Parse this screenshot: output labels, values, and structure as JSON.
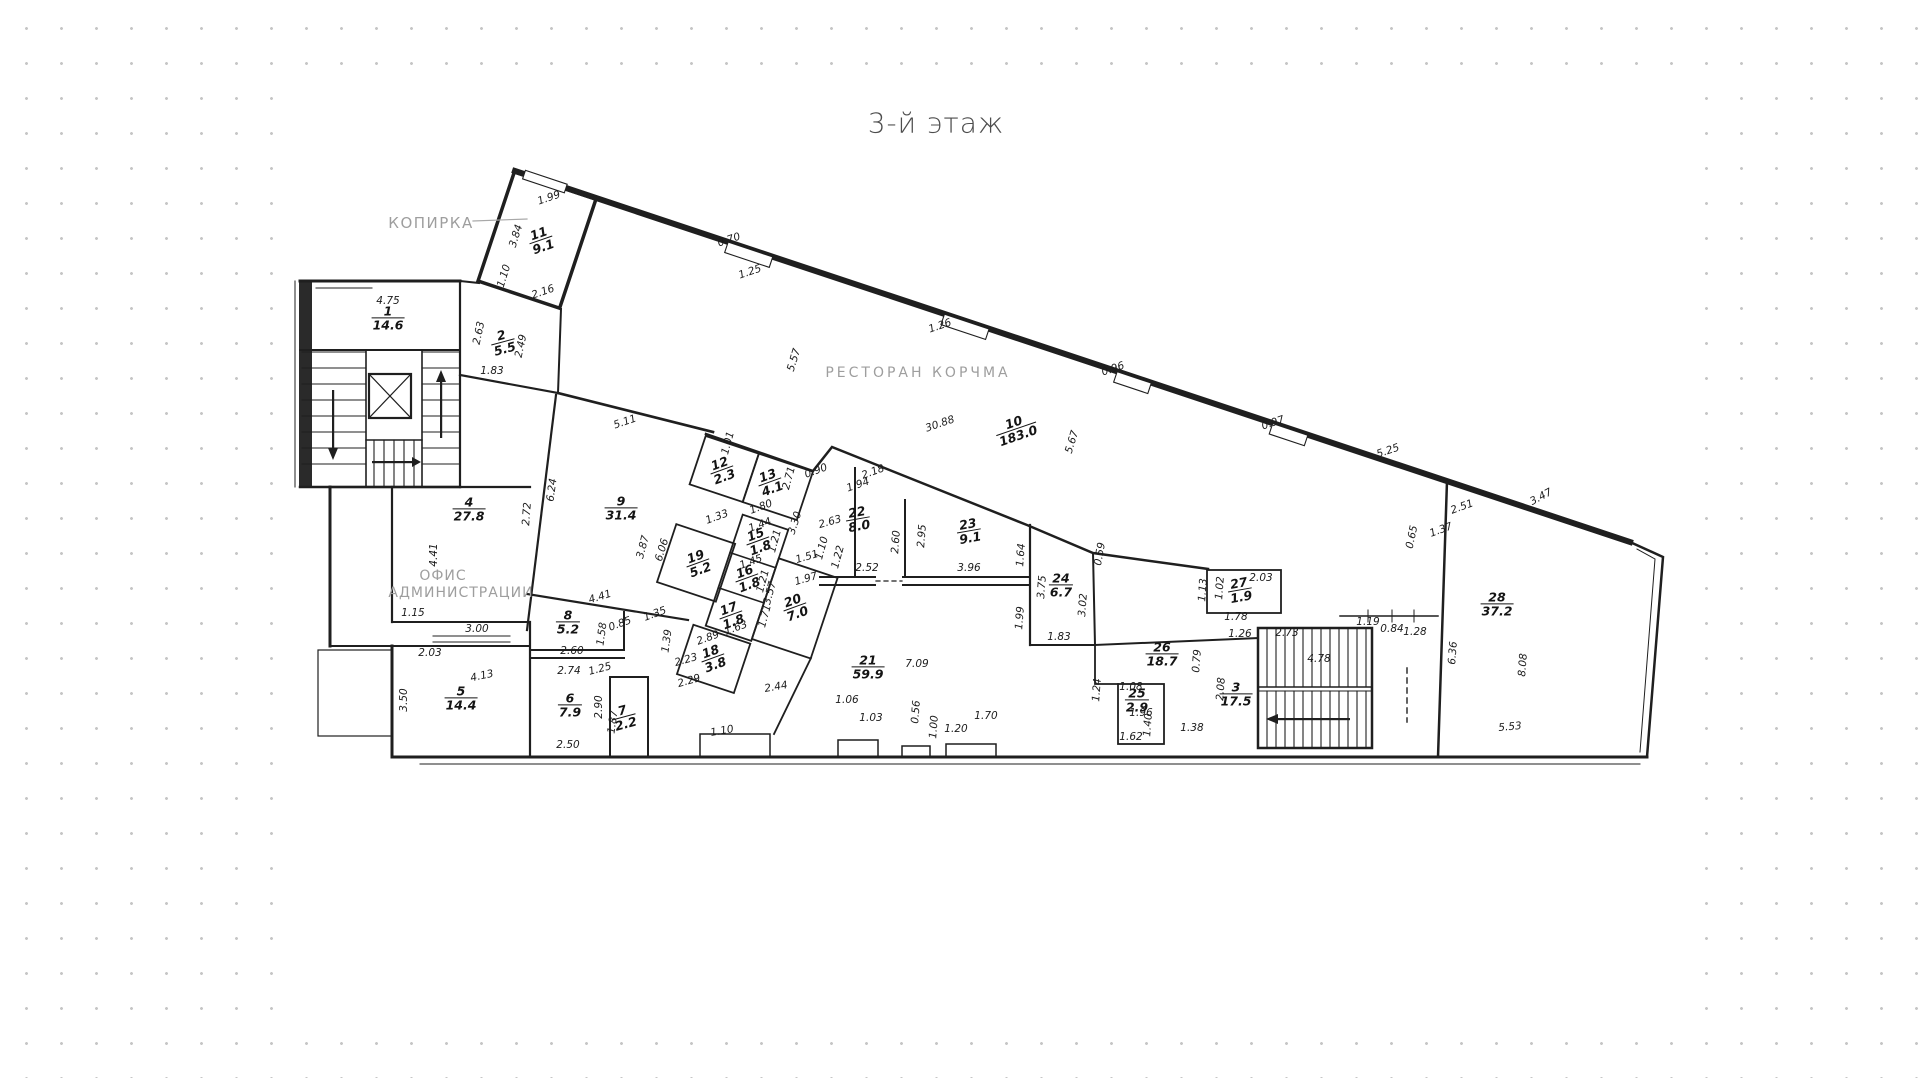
{
  "title": "3-й этаж",
  "labels": {
    "kopirka": "КОПИРКА",
    "restaurant": "РЕСТОРАН  КОРЧМА",
    "office_line1": "ОФИС",
    "office_line2": "АДМИНИСТРАЦИИ"
  },
  "colors": {
    "ink": "#1f1f1f",
    "muted_label": "#9e9e9e",
    "dots": "#c6c6c6",
    "paper": "#ffffff",
    "title_text": "#4d4d4d"
  },
  "rooms": [
    {
      "num": "1",
      "area": "14.6",
      "x": 388,
      "y": 318,
      "r": 0
    },
    {
      "num": "2",
      "area": "5.5",
      "x": 503,
      "y": 342,
      "r": -15
    },
    {
      "num": "3",
      "area": "17.5",
      "x": 1236,
      "y": 694,
      "r": 0
    },
    {
      "num": "4",
      "area": "27.8",
      "x": 469,
      "y": 509,
      "r": 0
    },
    {
      "num": "5",
      "area": "14.4",
      "x": 461,
      "y": 698,
      "r": 0
    },
    {
      "num": "6",
      "area": "7.9",
      "x": 570,
      "y": 705,
      "r": 0
    },
    {
      "num": "7",
      "area": "2.2",
      "x": 624,
      "y": 717,
      "r": -15
    },
    {
      "num": "8",
      "area": "5.2",
      "x": 568,
      "y": 622,
      "r": 0
    },
    {
      "num": "9",
      "area": "31.4",
      "x": 621,
      "y": 508,
      "r": 0
    },
    {
      "num": "10",
      "area": "183.0",
      "x": 1016,
      "y": 429,
      "r": -19
    },
    {
      "num": "11",
      "area": "9.1",
      "x": 541,
      "y": 240,
      "r": -19
    },
    {
      "num": "12",
      "area": "2.3",
      "x": 722,
      "y": 470,
      "r": -20
    },
    {
      "num": "13",
      "area": "4.1",
      "x": 770,
      "y": 482,
      "r": -20
    },
    {
      "num": "15",
      "area": "1.8",
      "x": 758,
      "y": 541,
      "r": -20
    },
    {
      "num": "16",
      "area": "1.8",
      "x": 747,
      "y": 578,
      "r": -20
    },
    {
      "num": "17",
      "area": "1.8",
      "x": 731,
      "y": 615,
      "r": -20
    },
    {
      "num": "18",
      "area": "3.8",
      "x": 713,
      "y": 658,
      "r": -20
    },
    {
      "num": "19",
      "area": "5.2",
      "x": 698,
      "y": 563,
      "r": -20
    },
    {
      "num": "20",
      "area": "7.0",
      "x": 795,
      "y": 607,
      "r": -20
    },
    {
      "num": "21",
      "area": "59.9",
      "x": 868,
      "y": 667,
      "r": 0
    },
    {
      "num": "22",
      "area": "8.0",
      "x": 858,
      "y": 519,
      "r": -10
    },
    {
      "num": "23",
      "area": "9.1",
      "x": 969,
      "y": 531,
      "r": -10
    },
    {
      "num": "24",
      "area": "6.7",
      "x": 1061,
      "y": 585,
      "r": 0
    },
    {
      "num": "25",
      "area": "2.9",
      "x": 1137,
      "y": 700,
      "r": 0
    },
    {
      "num": "26",
      "area": "18.7",
      "x": 1162,
      "y": 654,
      "r": 0
    },
    {
      "num": "27",
      "area": "1.9",
      "x": 1240,
      "y": 590,
      "r": -10
    },
    {
      "num": "28",
      "area": "37.2",
      "x": 1497,
      "y": 604,
      "r": 0
    }
  ],
  "dims": [
    {
      "t": "4.75",
      "x": 388,
      "y": 301,
      "r": 0
    },
    {
      "t": "2.63",
      "x": 479,
      "y": 333,
      "r": -78
    },
    {
      "t": "2.49",
      "x": 521,
      "y": 346,
      "r": -78
    },
    {
      "t": "1.83",
      "x": 492,
      "y": 371,
      "r": 0
    },
    {
      "t": "1.99",
      "x": 549,
      "y": 198,
      "r": -19
    },
    {
      "t": "3.84",
      "x": 516,
      "y": 236,
      "r": -73
    },
    {
      "t": "1.10",
      "x": 504,
      "y": 276,
      "r": -73
    },
    {
      "t": "2.16",
      "x": 543,
      "y": 292,
      "r": -19
    },
    {
      "t": "0.70",
      "x": 729,
      "y": 240,
      "r": -19
    },
    {
      "t": "1.25",
      "x": 750,
      "y": 272,
      "r": -19
    },
    {
      "t": "5.57",
      "x": 794,
      "y": 360,
      "r": -73
    },
    {
      "t": "1.26",
      "x": 940,
      "y": 326,
      "r": -19
    },
    {
      "t": "0.96",
      "x": 1113,
      "y": 369,
      "r": -19
    },
    {
      "t": "0.97",
      "x": 1273,
      "y": 423,
      "r": -19
    },
    {
      "t": "5.25",
      "x": 1388,
      "y": 451,
      "r": -19
    },
    {
      "t": "30.88",
      "x": 940,
      "y": 424,
      "r": -19
    },
    {
      "t": "5.67",
      "x": 1072,
      "y": 442,
      "r": -73
    },
    {
      "t": "5.11",
      "x": 625,
      "y": 422,
      "r": -19
    },
    {
      "t": "6.24",
      "x": 552,
      "y": 490,
      "r": -82
    },
    {
      "t": "6.06",
      "x": 662,
      "y": 550,
      "r": -73
    },
    {
      "t": "4.41",
      "x": 600,
      "y": 597,
      "r": -17
    },
    {
      "t": "4.41",
      "x": 434,
      "y": 555,
      "r": -90
    },
    {
      "t": "2.72",
      "x": 527,
      "y": 514,
      "r": -86
    },
    {
      "t": "1.15",
      "x": 413,
      "y": 613,
      "r": 0
    },
    {
      "t": "3.00",
      "x": 477,
      "y": 629,
      "r": 0
    },
    {
      "t": "2.03",
      "x": 430,
      "y": 653,
      "r": 0
    },
    {
      "t": "3.50",
      "x": 404,
      "y": 700,
      "r": -90
    },
    {
      "t": "4.13",
      "x": 482,
      "y": 676,
      "r": -12
    },
    {
      "t": "2.74",
      "x": 569,
      "y": 671,
      "r": 0
    },
    {
      "t": "2.90",
      "x": 599,
      "y": 707,
      "r": -90
    },
    {
      "t": "2.50",
      "x": 568,
      "y": 745,
      "r": 0
    },
    {
      "t": "2.60",
      "x": 572,
      "y": 651,
      "r": 0
    },
    {
      "t": "1.58",
      "x": 602,
      "y": 634,
      "r": -82
    },
    {
      "t": "0.85",
      "x": 620,
      "y": 624,
      "r": -20
    },
    {
      "t": "1.25",
      "x": 600,
      "y": 669,
      "r": -15
    },
    {
      "t": "1.87",
      "x": 613,
      "y": 722,
      "r": -82
    },
    {
      "t": "1.01",
      "x": 728,
      "y": 443,
      "r": -75
    },
    {
      "t": "1.80",
      "x": 761,
      "y": 507,
      "r": -20
    },
    {
      "t": "2.71",
      "x": 789,
      "y": 478,
      "r": -75
    },
    {
      "t": "1.94",
      "x": 858,
      "y": 485,
      "r": -19
    },
    {
      "t": "1.33",
      "x": 717,
      "y": 517,
      "r": -20
    },
    {
      "t": "1.44",
      "x": 760,
      "y": 525,
      "r": -20
    },
    {
      "t": "1.21",
      "x": 775,
      "y": 541,
      "r": -75
    },
    {
      "t": "1.45",
      "x": 751,
      "y": 562,
      "r": -20
    },
    {
      "t": "1.21",
      "x": 763,
      "y": 581,
      "r": -75
    },
    {
      "t": "1.63",
      "x": 736,
      "y": 628,
      "r": -20
    },
    {
      "t": "1.71",
      "x": 765,
      "y": 616,
      "r": -75
    },
    {
      "t": "3.87",
      "x": 643,
      "y": 547,
      "r": -75
    },
    {
      "t": "1.35",
      "x": 655,
      "y": 614,
      "r": -20
    },
    {
      "t": "1.39",
      "x": 667,
      "y": 641,
      "r": -82
    },
    {
      "t": "2.89",
      "x": 708,
      "y": 638,
      "r": -20
    },
    {
      "t": "2.23",
      "x": 686,
      "y": 660,
      "r": -16
    },
    {
      "t": "2.29",
      "x": 689,
      "y": 681,
      "r": -16
    },
    {
      "t": "2.44",
      "x": 776,
      "y": 687,
      "r": -10
    },
    {
      "t": "3.57",
      "x": 770,
      "y": 593,
      "r": -75
    },
    {
      "t": "1.97",
      "x": 806,
      "y": 579,
      "r": -16
    },
    {
      "t": "1.51",
      "x": 807,
      "y": 557,
      "r": -16
    },
    {
      "t": "1.10",
      "x": 822,
      "y": 548,
      "r": -75
    },
    {
      "t": "1.22",
      "x": 838,
      "y": 557,
      "r": -75
    },
    {
      "t": "2.52",
      "x": 867,
      "y": 568,
      "r": 0
    },
    {
      "t": "0.90",
      "x": 816,
      "y": 471,
      "r": -20
    },
    {
      "t": "3.30",
      "x": 795,
      "y": 523,
      "r": -72
    },
    {
      "t": "2.18",
      "x": 873,
      "y": 472,
      "r": -20
    },
    {
      "t": "2.63",
      "x": 830,
      "y": 522,
      "r": -16
    },
    {
      "t": "2.60",
      "x": 896,
      "y": 542,
      "r": -86
    },
    {
      "t": "2.95",
      "x": 922,
      "y": 536,
      "r": -86
    },
    {
      "t": "3.96",
      "x": 969,
      "y": 568,
      "r": 0
    },
    {
      "t": "1.64",
      "x": 1021,
      "y": 555,
      "r": -86
    },
    {
      "t": "3.75",
      "x": 1042,
      "y": 587,
      "r": -86
    },
    {
      "t": "1.99",
      "x": 1020,
      "y": 618,
      "r": -86
    },
    {
      "t": "3.02",
      "x": 1083,
      "y": 605,
      "r": -86
    },
    {
      "t": "1.83",
      "x": 1059,
      "y": 637,
      "r": 0
    },
    {
      "t": "0.59",
      "x": 1100,
      "y": 554,
      "r": -80
    },
    {
      "t": "1.13",
      "x": 1203,
      "y": 590,
      "r": -86
    },
    {
      "t": "1.02",
      "x": 1220,
      "y": 588,
      "r": -86
    },
    {
      "t": "2.03",
      "x": 1261,
      "y": 578,
      "r": 0
    },
    {
      "t": "1.78",
      "x": 1236,
      "y": 617,
      "r": 0
    },
    {
      "t": "1.26",
      "x": 1240,
      "y": 634,
      "r": 0
    },
    {
      "t": "2.73",
      "x": 1287,
      "y": 633,
      "r": 0
    },
    {
      "t": "1.19",
      "x": 1368,
      "y": 622,
      "r": 0
    },
    {
      "t": "0.84",
      "x": 1392,
      "y": 629,
      "r": 0
    },
    {
      "t": "1.28",
      "x": 1415,
      "y": 632,
      "r": 0
    },
    {
      "t": "4.78",
      "x": 1319,
      "y": 659,
      "r": 0
    },
    {
      "t": "0.79",
      "x": 1197,
      "y": 661,
      "r": -86
    },
    {
      "t": "2.08",
      "x": 1221,
      "y": 689,
      "r": -86
    },
    {
      "t": "1.24",
      "x": 1097,
      "y": 690,
      "r": -86
    },
    {
      "t": "1.08",
      "x": 1131,
      "y": 687,
      "r": 0
    },
    {
      "t": "1.96",
      "x": 1141,
      "y": 713,
      "r": 0
    },
    {
      "t": "1.40",
      "x": 1148,
      "y": 725,
      "r": -86
    },
    {
      "t": "1.62",
      "x": 1131,
      "y": 737,
      "r": 0
    },
    {
      "t": "1.38",
      "x": 1192,
      "y": 728,
      "r": 0
    },
    {
      "t": "1.06",
      "x": 847,
      "y": 700,
      "r": 0
    },
    {
      "t": "1.03",
      "x": 871,
      "y": 718,
      "r": 0
    },
    {
      "t": "0.56",
      "x": 916,
      "y": 712,
      "r": -86
    },
    {
      "t": "1.00",
      "x": 934,
      "y": 727,
      "r": -86
    },
    {
      "t": "1.20",
      "x": 956,
      "y": 729,
      "r": 0
    },
    {
      "t": "1.70",
      "x": 986,
      "y": 716,
      "r": 0
    },
    {
      "t": "1.10",
      "x": 722,
      "y": 731,
      "r": -10
    },
    {
      "t": "7.09",
      "x": 917,
      "y": 664,
      "r": 0
    },
    {
      "t": "3.47",
      "x": 1541,
      "y": 497,
      "r": -28
    },
    {
      "t": "2.51",
      "x": 1462,
      "y": 507,
      "r": -20
    },
    {
      "t": "1.37",
      "x": 1441,
      "y": 530,
      "r": -20
    },
    {
      "t": "0.65",
      "x": 1412,
      "y": 537,
      "r": -78
    },
    {
      "t": "6.36",
      "x": 1453,
      "y": 653,
      "r": -86
    },
    {
      "t": "8.08",
      "x": 1523,
      "y": 665,
      "r": -86
    },
    {
      "t": "5.53",
      "x": 1510,
      "y": 727,
      "r": -5
    }
  ]
}
